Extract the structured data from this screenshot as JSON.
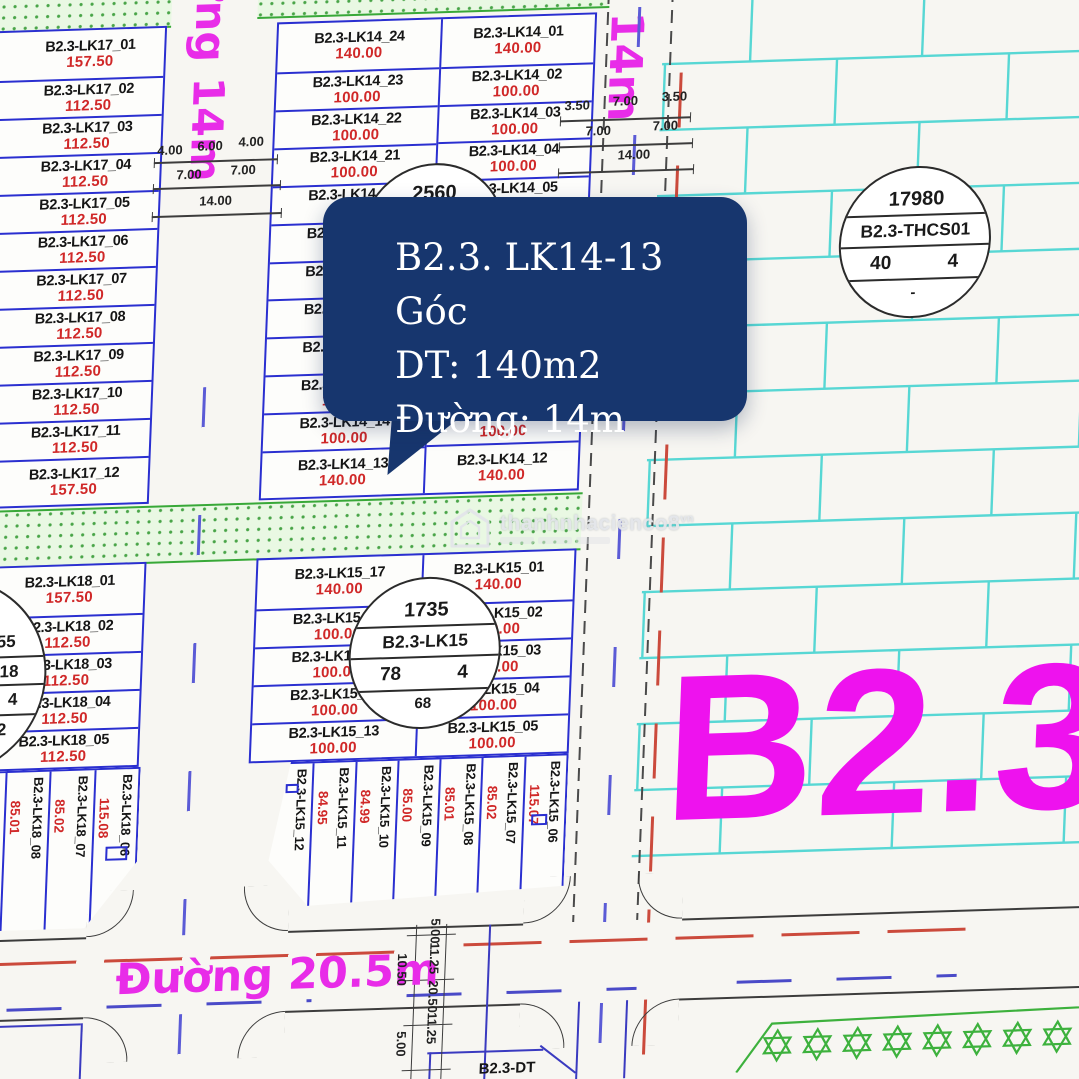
{
  "tooltip": {
    "title": "B2.3. LK14-13 Góc",
    "area": "DT: 140m2",
    "road": "Đường: 14m"
  },
  "watermark": {
    "brand": "thanhnhacienco8",
    "suffix": "vn"
  },
  "zone": {
    "label": "B2.3"
  },
  "roads": {
    "left": "Đường 14m",
    "right": "Đường 14m",
    "bottom": "Đường 20.5m"
  },
  "bottom_partial_label": "B2.3-DT",
  "dims": {
    "left_road": [
      "4.00",
      "6.00",
      "4.00",
      "7.00",
      "7.00",
      "14.00"
    ],
    "right_road": [
      "3.50",
      "7.00",
      "3.50",
      "7.00",
      "7.00",
      "14.00"
    ],
    "bottom_road": [
      "5.00",
      "11.25",
      "10.50",
      "20.50",
      "11.25",
      "5.00"
    ]
  },
  "circles": {
    "lk14": {
      "top": "2560"
    },
    "lk15": {
      "top": "1735",
      "name": "B2.3-LK15",
      "left": "78",
      "right": "4",
      "bottom": "68"
    },
    "thcs": {
      "top": "17980",
      "name": "B2.3-THCS01",
      "left": "40",
      "right": "4",
      "bottom": "-"
    },
    "lk18": {
      "top": "955",
      "name": "-LK18",
      "right": "4",
      "bottom": "72"
    }
  },
  "plots": {
    "lk17": [
      {
        "id": "B2.3-LK17_01",
        "area": "157.50"
      },
      {
        "id": "B2.3-LK17_02",
        "area": "112.50"
      },
      {
        "id": "B2.3-LK17_03",
        "area": "112.50"
      },
      {
        "id": "B2.3-LK17_04",
        "area": "112.50"
      },
      {
        "id": "B2.3-LK17_05",
        "area": "112.50"
      },
      {
        "id": "B2.3-LK17_06",
        "area": "112.50"
      },
      {
        "id": "B2.3-LK17_07",
        "area": "112.50"
      },
      {
        "id": "B2.3-LK17_08",
        "area": "112.50"
      },
      {
        "id": "B2.3-LK17_09",
        "area": "112.50"
      },
      {
        "id": "B2.3-LK17_10",
        "area": "112.50"
      },
      {
        "id": "B2.3-LK17_11",
        "area": "112.50"
      },
      {
        "id": "B2.3-LK17_12",
        "area": "157.50"
      }
    ],
    "lk14_left": [
      {
        "id": "B2.3-LK14_24",
        "area": "140.00"
      },
      {
        "id": "B2.3-LK14_23",
        "area": "100.00"
      },
      {
        "id": "B2.3-LK14_22",
        "area": "100.00"
      },
      {
        "id": "B2.3-LK14_21",
        "area": "100.00"
      },
      {
        "id": "B2.3-LK14_20",
        "area": "100.00"
      },
      {
        "id": "B2.3-LK14_19",
        "area": "100.00"
      },
      {
        "id": "B2.3-LK14_18",
        "area": "100.00"
      },
      {
        "id": "B2.3-LK14_17",
        "area": "100.00"
      },
      {
        "id": "B2.3-LK14_16",
        "area": "100.00"
      },
      {
        "id": "B2.3-LK14_15",
        "area": "100.00"
      },
      {
        "id": "B2.3-LK14_14",
        "area": "100.00"
      },
      {
        "id": "B2.3-LK14_13",
        "area": "140.00"
      }
    ],
    "lk14_right_top": [
      {
        "id": "B2.3-LK14_01",
        "area": "140.00"
      },
      {
        "id": "B2.3-LK14_02",
        "area": "100.00"
      },
      {
        "id": "B2.3-LK14_03",
        "area": "100.00"
      },
      {
        "id": "B2.3-LK14_04",
        "area": "100.00"
      },
      {
        "id": "B2.3-LK14_05",
        "area": "100.00"
      }
    ],
    "lk14_right_bottom": [
      {
        "id": "B2.3-LK14_11",
        "area": "100.00"
      },
      {
        "id": "B2.3-LK14_12",
        "area": "140.00"
      }
    ],
    "lk15_left": [
      {
        "id": "B2.3-LK15_17",
        "area": "140.00"
      },
      {
        "id": "B2.3-LK15_16",
        "area": "100.00"
      },
      {
        "id": "B2.3-LK15_15",
        "area": "100.00"
      },
      {
        "id": "B2.3-LK15_14",
        "area": "100.00"
      },
      {
        "id": "B2.3-LK15_13",
        "area": "100.00"
      }
    ],
    "lk15_right": [
      {
        "id": "B2.3-LK15_01",
        "area": "140.00"
      },
      {
        "id": "B2.3-LK15_02",
        "area": "100.00"
      },
      {
        "id": "B2.3-LK15_03",
        "area": "100.00"
      },
      {
        "id": "B2.3-LK15_04",
        "area": "100.00"
      },
      {
        "id": "B2.3-LK15_05",
        "area": "100.00"
      }
    ],
    "lk15_rot": [
      {
        "id": "B2.3-LK15_12",
        "area": "114.93"
      },
      {
        "id": "B2.3-LK15_11",
        "area": "84.95"
      },
      {
        "id": "B2.3-LK15_10",
        "area": "84.99"
      },
      {
        "id": "B2.3-LK15_09",
        "area": "85.00"
      },
      {
        "id": "B2.3-LK15_08",
        "area": "85.01"
      },
      {
        "id": "B2.3-LK15_07",
        "area": "85.02"
      },
      {
        "id": "B2.3-LK15_06",
        "area": "115.07"
      }
    ],
    "lk18": [
      {
        "id": "B2.3-LK18_01",
        "area": "157.50"
      },
      {
        "id": "B2.3-LK18_02",
        "area": "112.50"
      },
      {
        "id": "B2.3-LK18_03",
        "area": "112.50"
      },
      {
        "id": "B2.3-LK18_04",
        "area": "112.50"
      },
      {
        "id": "B2.3-LK18_05",
        "area": "112.50"
      }
    ],
    "lk18_rot": [
      {
        "id": "B2.3-LK18_09",
        "area": "85.00"
      },
      {
        "id": "B2.3-LK18_08",
        "area": "85.01"
      },
      {
        "id": "B2.3-LK18_07",
        "area": "85.02"
      },
      {
        "id": "B2.3-LK18_06",
        "area": "115.08"
      }
    ]
  }
}
